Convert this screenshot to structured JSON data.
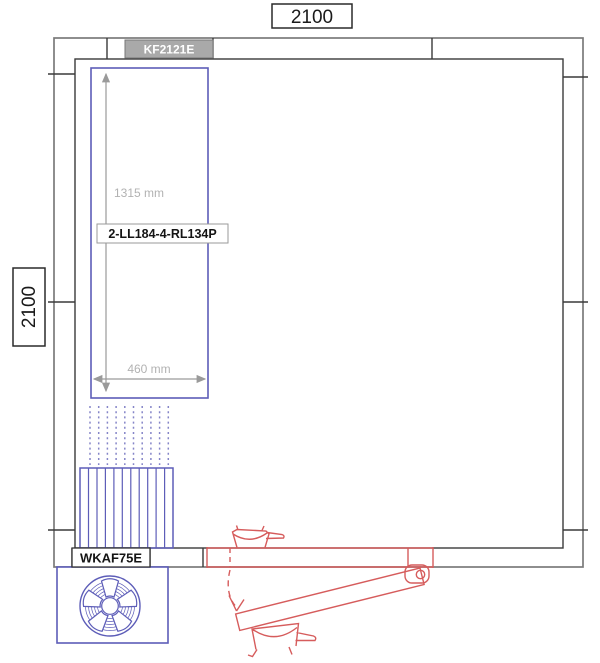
{
  "drawing": {
    "top_dimension": "2100",
    "left_dimension": "2100",
    "panel_label": "KF2121E",
    "unit_label": "2-LL184-4-RL134P",
    "evaporator_label": "WKAF75E",
    "unit_height": "1315 mm",
    "unit_width": "460 mm",
    "icons": {
      "fan": "fan-icon",
      "swing": "door-swing-arrow-icon"
    },
    "colors": {
      "component_blue": "#5d5db8",
      "airflow_blue": "#8585c8",
      "door_red": "#d65c5c",
      "dimension_gray": "#9a9a9a",
      "measurement_text_gray": "#b2b2b2",
      "wall_outer_gray": "#7a7a7a",
      "wall_inner_dark": "#3a3a3a",
      "panel_label_bg": "#a9a9a9"
    }
  }
}
